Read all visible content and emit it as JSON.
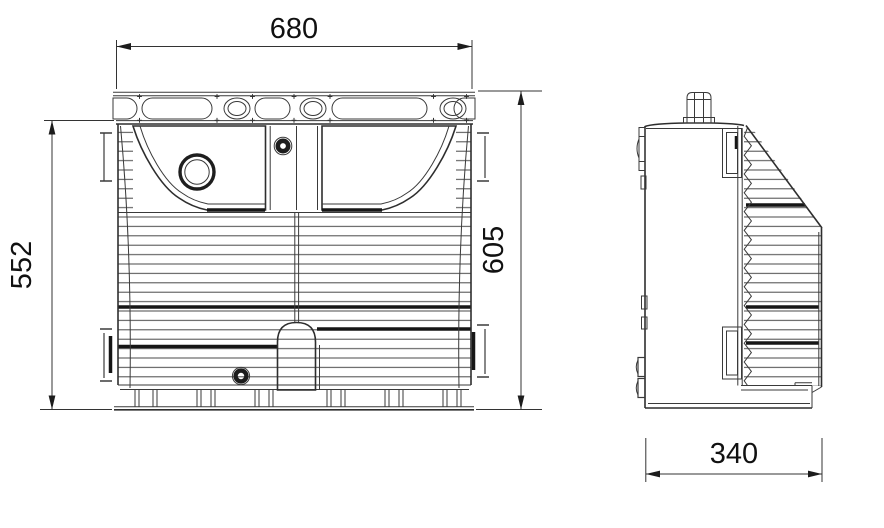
{
  "drawing": {
    "line_color": "#2e2e2e",
    "dimensions": {
      "front_width": "680",
      "front_height_left": "552",
      "front_height_right": "605",
      "side_depth": "340"
    }
  }
}
